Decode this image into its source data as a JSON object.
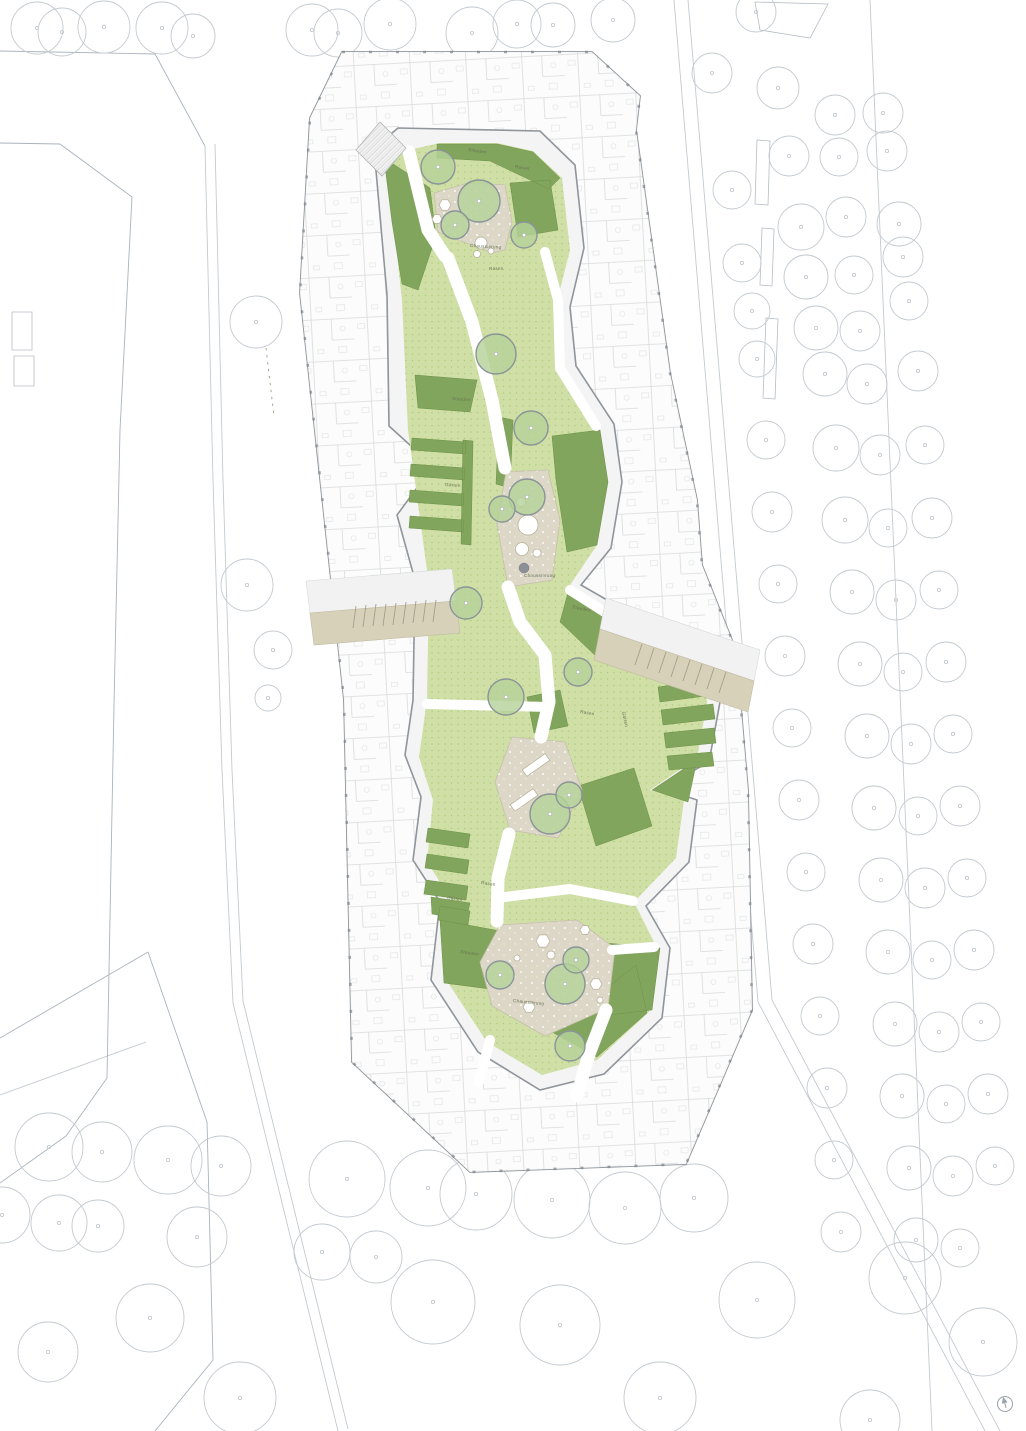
{
  "plan": {
    "kind": "architectural-site-plan",
    "area_label_terms": {
      "lawn": "Rasen",
      "perennials": "Stauden",
      "gravel": "Chaussierung",
      "gardens": "Gärten"
    }
  },
  "colors": {
    "lawn": "#cfdfa5",
    "lawn_dot": "#a8c577",
    "perennial": "#81a55c",
    "tree_fill": "#b5d29a",
    "tree_stroke": "#8b9499",
    "gravel": "#dcd7c6",
    "road": "#d8d1ba",
    "wall": "#8f959b",
    "context": "#c4cad1",
    "path_white": "#ffffff"
  },
  "area_labels": [
    {
      "text": "Stauden",
      "x": 468,
      "y": 151,
      "rot": 8
    },
    {
      "text": "Rasen",
      "x": 515,
      "y": 168,
      "rot": 8
    },
    {
      "text": "Chaussierung",
      "x": 470,
      "y": 247,
      "rot": 3
    },
    {
      "text": "Rasen",
      "x": 489,
      "y": 270,
      "rot": 0
    },
    {
      "text": "Stauden",
      "x": 452,
      "y": 400,
      "rot": 4
    },
    {
      "text": "Gärten",
      "x": 445,
      "y": 486,
      "rot": 4
    },
    {
      "text": "Chaussierung",
      "x": 524,
      "y": 577,
      "rot": 0
    },
    {
      "text": "Stauden",
      "x": 572,
      "y": 608,
      "rot": 12
    },
    {
      "text": "Rasen",
      "x": 580,
      "y": 713,
      "rot": 10
    },
    {
      "text": "Gärten",
      "x": 622,
      "y": 712,
      "rot": 78
    },
    {
      "text": "Rasen",
      "x": 481,
      "y": 884,
      "rot": 8
    },
    {
      "text": "Gärten",
      "x": 447,
      "y": 899,
      "rot": 8
    },
    {
      "text": "Stauden",
      "x": 460,
      "y": 953,
      "rot": 8
    },
    {
      "text": "Chaussierung",
      "x": 513,
      "y": 1002,
      "rot": 6
    }
  ],
  "courtyard_trees": [
    {
      "x": 438,
      "y": 167,
      "r": 17
    },
    {
      "x": 479,
      "y": 201,
      "r": 21
    },
    {
      "x": 455,
      "y": 225,
      "r": 14
    },
    {
      "x": 524,
      "y": 235,
      "r": 13
    },
    {
      "x": 496,
      "y": 354,
      "r": 20
    },
    {
      "x": 531,
      "y": 428,
      "r": 17
    },
    {
      "x": 527,
      "y": 497,
      "r": 18
    },
    {
      "x": 502,
      "y": 509,
      "r": 13
    },
    {
      "x": 466,
      "y": 603,
      "r": 16
    },
    {
      "x": 506,
      "y": 697,
      "r": 18
    },
    {
      "x": 578,
      "y": 672,
      "r": 14
    },
    {
      "x": 550,
      "y": 814,
      "r": 20
    },
    {
      "x": 569,
      "y": 795,
      "r": 13
    },
    {
      "x": 500,
      "y": 975,
      "r": 14
    },
    {
      "x": 565,
      "y": 984,
      "r": 20
    },
    {
      "x": 576,
      "y": 960,
      "r": 13
    },
    {
      "x": 570,
      "y": 1046,
      "r": 15
    }
  ],
  "context_trees": [
    [
      37,
      28,
      26
    ],
    [
      62,
      32,
      24
    ],
    [
      104,
      27,
      26
    ],
    [
      162,
      28,
      26
    ],
    [
      193,
      36,
      22
    ],
    [
      312,
      30,
      26
    ],
    [
      338,
      33,
      24
    ],
    [
      390,
      24,
      26
    ],
    [
      472,
      33,
      26
    ],
    [
      517,
      24,
      24
    ],
    [
      553,
      25,
      22
    ],
    [
      613,
      20,
      22
    ],
    [
      756,
      12,
      20
    ],
    [
      712,
      73,
      20
    ],
    [
      778,
      88,
      21
    ],
    [
      835,
      115,
      20
    ],
    [
      883,
      113,
      20
    ],
    [
      789,
      156,
      20
    ],
    [
      839,
      157,
      19
    ],
    [
      887,
      151,
      20
    ],
    [
      732,
      190,
      19
    ],
    [
      801,
      227,
      23
    ],
    [
      846,
      217,
      20
    ],
    [
      899,
      224,
      22
    ],
    [
      742,
      263,
      19
    ],
    [
      806,
      277,
      22
    ],
    [
      854,
      275,
      19
    ],
    [
      903,
      257,
      20
    ],
    [
      752,
      311,
      18
    ],
    [
      816,
      328,
      22
    ],
    [
      860,
      331,
      20
    ],
    [
      909,
      301,
      19
    ],
    [
      757,
      359,
      18
    ],
    [
      825,
      374,
      22
    ],
    [
      867,
      384,
      20
    ],
    [
      918,
      371,
      20
    ],
    [
      766,
      440,
      19
    ],
    [
      836,
      448,
      23
    ],
    [
      880,
      455,
      20
    ],
    [
      925,
      445,
      19
    ],
    [
      772,
      512,
      20
    ],
    [
      845,
      520,
      23
    ],
    [
      888,
      528,
      19
    ],
    [
      932,
      518,
      20
    ],
    [
      778,
      584,
      19
    ],
    [
      852,
      592,
      22
    ],
    [
      896,
      600,
      20
    ],
    [
      939,
      590,
      19
    ],
    [
      785,
      656,
      20
    ],
    [
      860,
      664,
      22
    ],
    [
      903,
      672,
      19
    ],
    [
      946,
      662,
      20
    ],
    [
      792,
      728,
      19
    ],
    [
      867,
      736,
      22
    ],
    [
      911,
      744,
      20
    ],
    [
      953,
      734,
      19
    ],
    [
      799,
      800,
      20
    ],
    [
      874,
      808,
      22
    ],
    [
      918,
      816,
      19
    ],
    [
      960,
      806,
      20
    ],
    [
      806,
      872,
      19
    ],
    [
      881,
      880,
      22
    ],
    [
      925,
      888,
      20
    ],
    [
      967,
      878,
      19
    ],
    [
      813,
      944,
      20
    ],
    [
      888,
      952,
      22
    ],
    [
      932,
      960,
      19
    ],
    [
      974,
      950,
      20
    ],
    [
      820,
      1016,
      19
    ],
    [
      895,
      1024,
      22
    ],
    [
      939,
      1032,
      20
    ],
    [
      981,
      1022,
      19
    ],
    [
      827,
      1088,
      20
    ],
    [
      902,
      1096,
      22
    ],
    [
      946,
      1104,
      19
    ],
    [
      988,
      1094,
      20
    ],
    [
      834,
      1160,
      19
    ],
    [
      909,
      1168,
      22
    ],
    [
      953,
      1176,
      20
    ],
    [
      995,
      1166,
      19
    ],
    [
      841,
      1232,
      20
    ],
    [
      916,
      1240,
      22
    ],
    [
      960,
      1248,
      19
    ],
    [
      256,
      322,
      26
    ],
    [
      247,
      585,
      26
    ],
    [
      273,
      650,
      19
    ],
    [
      268,
      698,
      13
    ],
    [
      49,
      1147,
      34
    ],
    [
      102,
      1152,
      30
    ],
    [
      168,
      1160,
      34
    ],
    [
      221,
      1166,
      30
    ],
    [
      2,
      1215,
      28
    ],
    [
      59,
      1223,
      28
    ],
    [
      98,
      1226,
      26
    ],
    [
      197,
      1237,
      30
    ],
    [
      347,
      1179,
      38
    ],
    [
      428,
      1188,
      38
    ],
    [
      476,
      1194,
      36
    ],
    [
      552,
      1200,
      38
    ],
    [
      625,
      1208,
      36
    ],
    [
      694,
      1198,
      34
    ],
    [
      322,
      1252,
      28
    ],
    [
      376,
      1257,
      26
    ],
    [
      433,
      1302,
      42
    ],
    [
      560,
      1325,
      40
    ],
    [
      757,
      1300,
      38
    ],
    [
      905,
      1278,
      36
    ],
    [
      983,
      1342,
      34
    ],
    [
      660,
      1398,
      36
    ],
    [
      150,
      1318,
      34
    ],
    [
      48,
      1352,
      30
    ],
    [
      240,
      1398,
      36
    ],
    [
      870,
      1420,
      30
    ],
    [
      677,
      637,
      23
    ]
  ],
  "compass": {
    "symbol": "north-arrow"
  }
}
